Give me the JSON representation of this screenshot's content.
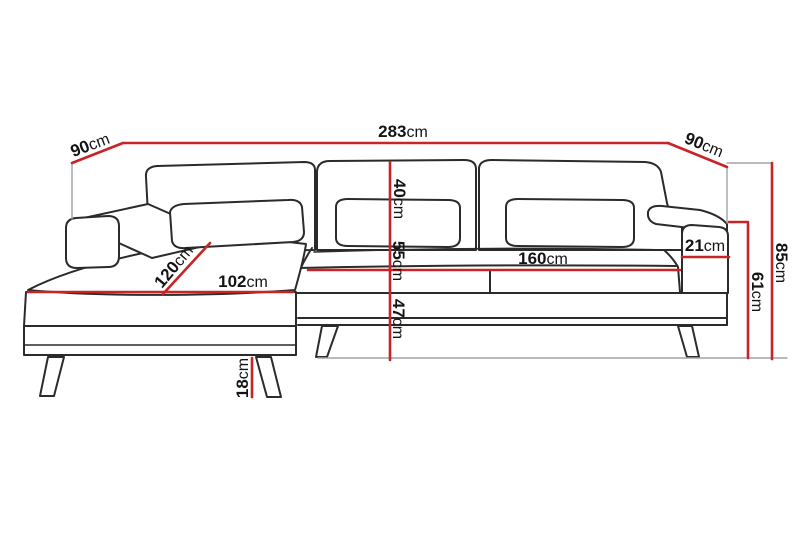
{
  "diagram": {
    "type": "sofa-dimension-drawing",
    "unit": "cm",
    "dimensions": {
      "total_width": {
        "value": "283",
        "unit": "cm"
      },
      "back_depth_left": {
        "value": "90",
        "unit": "cm"
      },
      "back_depth_right": {
        "value": "90",
        "unit": "cm"
      },
      "total_height": {
        "value": "85",
        "unit": "cm"
      },
      "armrest_height": {
        "value": "61",
        "unit": "cm"
      },
      "armrest_thickness": {
        "value": "21",
        "unit": "cm"
      },
      "backrest_cushion_height": {
        "value": "40",
        "unit": "cm"
      },
      "seat_height": {
        "value": "55",
        "unit": "cm"
      },
      "frame_height": {
        "value": "47",
        "unit": "cm"
      },
      "chaise_depth": {
        "value": "120",
        "unit": "cm"
      },
      "chaise_width": {
        "value": "102",
        "unit": "cm"
      },
      "seat_width": {
        "value": "160",
        "unit": "cm"
      },
      "leg_height": {
        "value": "18",
        "unit": "cm"
      }
    },
    "colors": {
      "dimension_line": "#c92327",
      "drawing_outline": "#2b2b2b",
      "guide_line": "#a3a3a3",
      "label_text": "#141414",
      "background": "#ffffff"
    }
  }
}
